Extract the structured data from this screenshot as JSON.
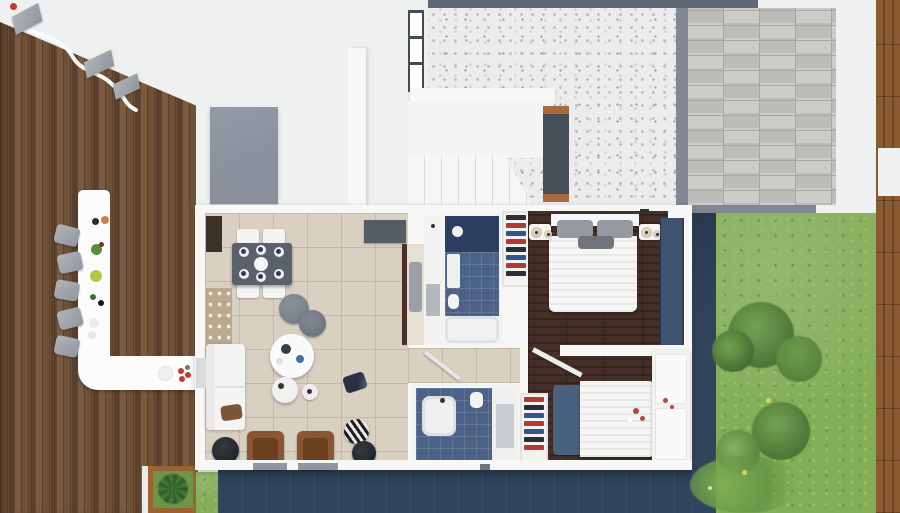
{
  "meta": {
    "scene": "3d-rendered-floor-plan-top-view",
    "canvas_width_px": 900,
    "canvas_height_px": 513
  },
  "palette": {
    "roof-white": "#eff0f0",
    "top-band": "#5f6874",
    "terrazzo-base": "#ececec",
    "terrazzo-dot-a": "#b5b6b8",
    "terrazzo-dot-b": "#cfd0d1",
    "terrazzo-dot-c": "#9b9c9e",
    "paver-base": "#c7c6c3",
    "paver-line": "#a8a7a4",
    "wall-gray": "#818893",
    "wood-edge": "#8a5a30",
    "wood-edge-dark": "#6f4523",
    "deck-a": "#6f5138",
    "deck-b": "#5b402d",
    "deck-c": "#7a5a40",
    "gray-roof": "#8a919d",
    "stairs-line": "#d9dadb",
    "bench-dark": "#474f58",
    "bench-cap": "#a86a3e",
    "grass-base": "#83ad57",
    "grass-light": "#97bf68",
    "grass-dark": "#6f9a47",
    "bush-a": "#557f3d",
    "bush-b": "#40662f",
    "bush-light": "#74a352",
    "terrace-blue": "#30445b",
    "wall-white": "#f7f7f6",
    "tile-base": "#d9d0c2",
    "wood-floor-a": "#452f28",
    "wood-floor-b": "#372420",
    "bath-blue": "#4d6287",
    "bath-blue-dark": "#2c3f63",
    "closet-red": "#b23a34",
    "closet-blue": "#34548c",
    "closet-dark": "#2a2e38",
    "furn-white": "#f4f4f3",
    "pillow-gray": "#96999d",
    "table-dark": "#5a616b",
    "stool-a": "#b0b5ba",
    "stool-b": "#8f959b",
    "sofa-pillow-brown": "#7d5436",
    "armchair-a": "#8a5632",
    "armchair-b": "#6a401f",
    "black-table": "#22262d",
    "bed2-blue": "#49617f",
    "pouf-a": "#777d86",
    "pouf-b": "#6d737c",
    "counter-dark": "#4a2f28",
    "appliance-gray": "#9aa0a6",
    "lamp-shade": "#c9c3ae",
    "plate-navy": "#2c3a5e",
    "lime": "#b5c743",
    "tomato": "#c23b2e",
    "leaf": "#5a8f3a",
    "orange-fruit": "#c8804b",
    "flower-red": "#b4483f",
    "planter-wood": "#9b6332",
    "plant-a": "#2f5d2b",
    "plant-b": "#447735",
    "door-gray": "#c9ccd0",
    "cooktop-gray": "#565c66"
  },
  "scene": {
    "outdoor": {
      "deck": "wood-plank-deck",
      "bar": "l-shaped-white-bar-counter",
      "bar_stool_count": 5,
      "upper_patio": "terrazzo-speckled-patio",
      "paver_patio": "gray-brick-paver-patio",
      "lawn": "grass-lawn",
      "bush_count": 2,
      "terrace": "navy-blue-terrace-walkway",
      "planter": "palm-planter-box",
      "staircase_step_count": 7
    },
    "rooms": [
      {
        "name": "living-dining-room",
        "floor": "beige-tile",
        "furniture": [
          "dining-table",
          "dining-chairs-4",
          "striped-plates-6",
          "floor-poufs-2",
          "round-coffee-tables-3",
          "white-sofa",
          "leather-armchairs-2",
          "black-side-tables-2",
          "zebra-pouf",
          "wall-shelf"
        ]
      },
      {
        "name": "kitchen",
        "floor": "beige-tile",
        "furniture": [
          "cooktop",
          "counter-run",
          "sink",
          "vanity"
        ]
      },
      {
        "name": "bathroom-1",
        "floor": "blue-tile",
        "furniture": [
          "dark-vanity",
          "shower",
          "toilet",
          "bathtub"
        ]
      },
      {
        "name": "master-bedroom",
        "floor": "dark-wood",
        "furniture": [
          "double-bed",
          "gray-pillows-2",
          "nightstands-2",
          "ball-lamps",
          "navy-wardrobe"
        ]
      },
      {
        "name": "bathroom-2",
        "floor": "blue-tile",
        "furniture": [
          "bathtub",
          "white-partition-door"
        ]
      },
      {
        "name": "bedroom-2",
        "floor": "dark-wood",
        "furniture": [
          "bed-blue-headboard",
          "floral-throw",
          "white-chaise"
        ]
      },
      {
        "name": "walk-in-closets",
        "count": 2,
        "contents": "hanging-clothes-red-blue-dark"
      }
    ]
  }
}
